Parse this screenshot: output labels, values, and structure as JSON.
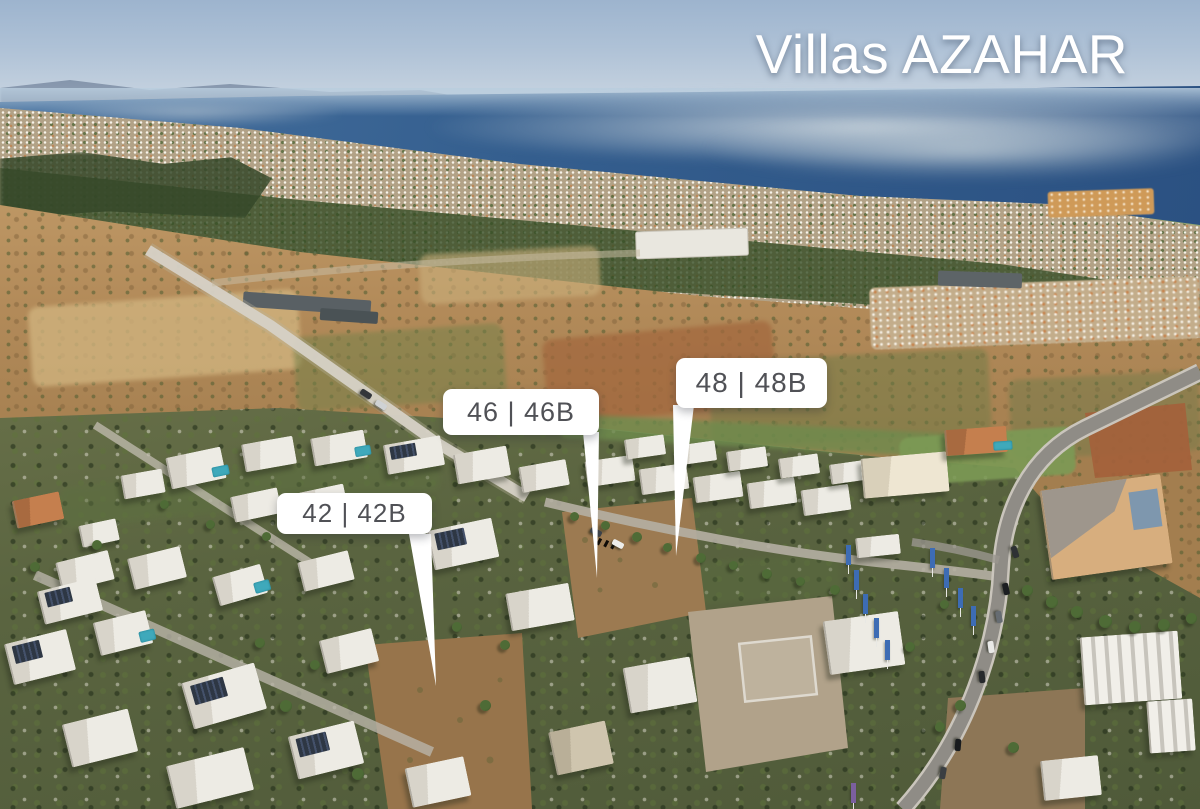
{
  "title": "Villas AZAHAR",
  "plots": [
    {
      "id": "42",
      "label": "42 | 42B"
    },
    {
      "id": "46",
      "label": "46 | 46B"
    },
    {
      "id": "48",
      "label": "48 | 48B"
    }
  ],
  "photo": {
    "description": "Aerial drone photograph of a coastal villa development: white modern villas and vacant brown plots in the foreground, countryside fields and coastal towns in the midground, and the Mediterranean Sea with a fog bank on the hazy horizon",
    "colors": {
      "sky": "#a9bdd3",
      "sea": "#33598a",
      "fog": "#c3ccd3",
      "fields": "#b8925f",
      "vegetation": "#5d6b42",
      "villa_white": "#edebe4",
      "dirt_plot": "#9c7a51",
      "pool": "#3fa9bb",
      "flag_blue": "#3d6cb4",
      "label_background": "#ffffff",
      "label_text": "#505156",
      "title_text": "#ffffff"
    }
  }
}
